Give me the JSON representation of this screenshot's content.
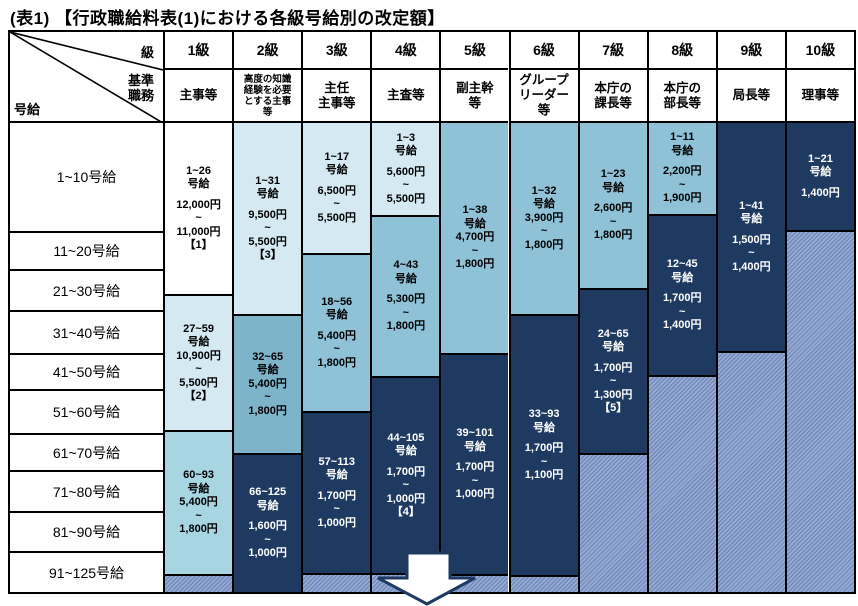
{
  "title": "(表1) 【行政職給料表(1)における各級号給別の改定額】",
  "corner": {
    "grade": "級",
    "duty_lines": [
      "基準",
      "職務"
    ],
    "step": "号給"
  },
  "row_labels": [
    "1~10号給",
    "11~20号給",
    "21~30号給",
    "31~40号給",
    "41~50号給",
    "51~60号給",
    "61~70号給",
    "71~80号給",
    "81~90号給",
    "91~125号給"
  ],
  "palette": {
    "white": "#ffffff",
    "pale": "#d5e9f2",
    "light": "#a7d5e2",
    "medium": "#8fc2d6",
    "steel": "#7db4ca",
    "navy": "#1f3a60",
    "hatch_base": "#95aad2",
    "hatch_stripe": "#6a83b5",
    "border": "#000000",
    "text_on_navy": "#ffffff"
  },
  "columns": [
    {
      "grade": "1級",
      "duty_lines": [
        "主事等"
      ],
      "blocks": [
        {
          "color": "white",
          "lines": [
            "1~26",
            "号給",
            "",
            "12,000円",
            "~",
            "11,000円",
            "【1】"
          ]
        },
        {
          "color": "pale",
          "lines": [
            "27~59",
            "号給",
            "10,900円",
            "~",
            "5,500円",
            "【2】"
          ]
        },
        {
          "color": "light",
          "lines": [
            "60~93",
            "号給",
            "5,400円",
            "~",
            "1,800円"
          ]
        }
      ]
    },
    {
      "grade": "2級",
      "duty_lines": [
        "高度の知識",
        "経験を必要",
        "とする主事",
        "等"
      ],
      "duty_small": true,
      "blocks": [
        {
          "color": "pale",
          "lines": [
            "1~31",
            "号給",
            "",
            "9,500円",
            "~",
            "5,500円",
            "【3】"
          ]
        },
        {
          "color": "steel",
          "lines": [
            "32~65",
            "号給",
            "5,400円",
            "~",
            "1,800円"
          ]
        },
        {
          "color": "navy",
          "lines": [
            "66~125",
            "号給",
            "",
            "1,600円",
            "~",
            "1,000円"
          ]
        }
      ]
    },
    {
      "grade": "3級",
      "duty_lines": [
        "主任",
        "主事等"
      ],
      "blocks": [
        {
          "color": "pale",
          "lines": [
            "1~17",
            "号給",
            "",
            "6,500円",
            "~",
            "5,500円"
          ]
        },
        {
          "color": "medium",
          "lines": [
            "18~56",
            "号給",
            "",
            "5,400円",
            "~",
            "1,800円"
          ]
        },
        {
          "color": "navy",
          "lines": [
            "57~113",
            "号給",
            "",
            "1,700円",
            "~",
            "1,000円"
          ]
        }
      ]
    },
    {
      "grade": "4級",
      "duty_lines": [
        "主査等"
      ],
      "blocks": [
        {
          "color": "pale",
          "lines": [
            "1~3",
            "号給",
            "",
            "5,600円",
            "~",
            "5,500円"
          ]
        },
        {
          "color": "medium",
          "lines": [
            "4~43",
            "号給",
            "",
            "5,300円",
            "~",
            "1,800円"
          ]
        },
        {
          "color": "navy",
          "lines": [
            "44~105",
            "号給",
            "",
            "1,700円",
            "~",
            "1,000円",
            "【4】"
          ]
        }
      ]
    },
    {
      "grade": "5級",
      "duty_lines": [
        "副主幹",
        "等"
      ],
      "blocks": [
        {
          "color": "medium",
          "lines": [
            "1~38",
            "号給",
            "4,700円",
            "~",
            "1,800円"
          ]
        },
        {
          "color": "navy",
          "lines": [
            "39~101",
            "号給",
            "",
            "1,700円",
            "~",
            "1,000円"
          ]
        }
      ]
    },
    {
      "grade": "6級",
      "duty_lines": [
        "グループ",
        "リーダー",
        "等"
      ],
      "blocks": [
        {
          "color": "medium",
          "lines": [
            "1~32",
            "号給",
            "3,900円",
            "~",
            "1,800円"
          ]
        },
        {
          "color": "navy",
          "lines": [
            "33~93",
            "号給",
            "",
            "1,700円",
            "~",
            "1,100円"
          ]
        }
      ]
    },
    {
      "grade": "7級",
      "duty_lines": [
        "本庁の",
        "課長等"
      ],
      "blocks": [
        {
          "color": "medium",
          "lines": [
            "1~23",
            "号給",
            "",
            "2,600円",
            "~",
            "1,800円"
          ]
        },
        {
          "color": "navy",
          "lines": [
            "24~65",
            "号給",
            "",
            "1,700円",
            "~",
            "1,300円",
            "【5】"
          ]
        }
      ]
    },
    {
      "grade": "8級",
      "duty_lines": [
        "本庁の",
        "部長等"
      ],
      "blocks": [
        {
          "color": "medium",
          "lines": [
            "1~11",
            "号給",
            "",
            "2,200円",
            "~",
            "1,900円"
          ]
        },
        {
          "color": "navy",
          "lines": [
            "12~45",
            "号給",
            "",
            "1,700円",
            "~",
            "1,400円"
          ]
        }
      ]
    },
    {
      "grade": "9級",
      "duty_lines": [
        "局長等"
      ],
      "blocks": [
        {
          "color": "navy",
          "lines": [
            "1~41",
            "号給",
            "",
            "1,500円",
            "~",
            "1,400円"
          ]
        }
      ]
    },
    {
      "grade": "10級",
      "duty_lines": [
        "理事等"
      ],
      "blocks": [
        {
          "color": "navy",
          "lines": [
            "1~21",
            "号給",
            "",
            "1,400円"
          ]
        }
      ]
    }
  ]
}
